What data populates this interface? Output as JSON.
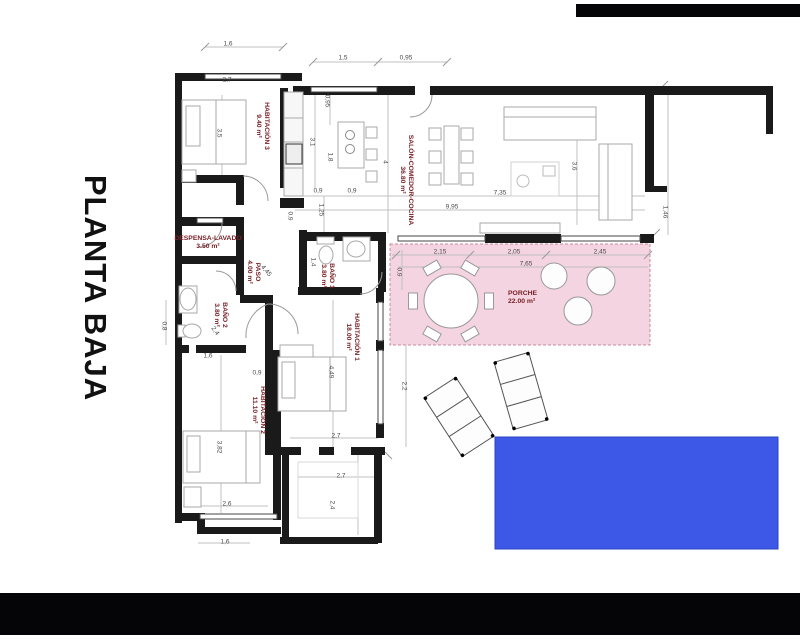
{
  "title": {
    "text": "PLANTA BAJA"
  },
  "plan": {
    "rooms": [
      {
        "name": "HABITACIÓN 3",
        "area": "9.40 m²",
        "x": 262,
        "y": 126,
        "rot": 90
      },
      {
        "name": "SALÓN-COMEDOR-COCINA",
        "area": "36.80 m²",
        "x": 406,
        "y": 180,
        "rot": 90
      },
      {
        "name": "DESPENSA-LAVADO",
        "area": "3.50 m²",
        "x": 208,
        "y": 243,
        "rot": 0
      },
      {
        "name": "PASO",
        "area": "4.00 m²",
        "x": 253,
        "y": 272,
        "rot": 90
      },
      {
        "name": "BAÑO 1",
        "area": "3.80 m²",
        "x": 327,
        "y": 276,
        "rot": 90
      },
      {
        "name": "BAÑO 2",
        "area": "3.80 m²",
        "x": 220,
        "y": 315,
        "rot": 90
      },
      {
        "name": "HABITACIÓN 1",
        "area": "18.00 m²",
        "x": 352,
        "y": 337,
        "rot": 90
      },
      {
        "name": "HABITACIÓN 2",
        "area": "11.10 m²",
        "x": 258,
        "y": 410,
        "rot": 90
      },
      {
        "name": "PORCHE",
        "area": "22.00 m²",
        "x": 508,
        "y": 298,
        "rot": 0,
        "align": "left"
      }
    ],
    "dimensions": [
      {
        "text": "1,6",
        "x": 228,
        "y": 44,
        "rot": 0
      },
      {
        "text": "2,7",
        "x": 227,
        "y": 80,
        "rot": 0
      },
      {
        "text": "3,5",
        "x": 219,
        "y": 133,
        "rot": 90
      },
      {
        "text": "1,5",
        "x": 343,
        "y": 58,
        "rot": 0
      },
      {
        "text": "0,95",
        "x": 406,
        "y": 58,
        "rot": 0
      },
      {
        "text": "0,95",
        "x": 327,
        "y": 101,
        "rot": 90
      },
      {
        "text": "3,1",
        "x": 312,
        "y": 142,
        "rot": 90
      },
      {
        "text": "1,8",
        "x": 330,
        "y": 157,
        "rot": 90
      },
      {
        "text": "4",
        "x": 385,
        "y": 162,
        "rot": 90
      },
      {
        "text": "3,6",
        "x": 574,
        "y": 166,
        "rot": 90
      },
      {
        "text": "7,35",
        "x": 500,
        "y": 193,
        "rot": 0
      },
      {
        "text": "9,95",
        "x": 452,
        "y": 207,
        "rot": 0
      },
      {
        "text": "0,9",
        "x": 318,
        "y": 191,
        "rot": 0
      },
      {
        "text": "0,9",
        "x": 352,
        "y": 191,
        "rot": 0
      },
      {
        "text": "1,25",
        "x": 321,
        "y": 210,
        "rot": 90
      },
      {
        "text": "0,9",
        "x": 290,
        "y": 216,
        "rot": 90
      },
      {
        "text": "1,46",
        "x": 665,
        "y": 212,
        "rot": 90
      },
      {
        "text": "2,15",
        "x": 440,
        "y": 252,
        "rot": 0
      },
      {
        "text": "2,05",
        "x": 514,
        "y": 252,
        "rot": 0
      },
      {
        "text": "2,45",
        "x": 600,
        "y": 252,
        "rot": 0
      },
      {
        "text": "7,65",
        "x": 526,
        "y": 264,
        "rot": 0
      },
      {
        "text": "0,9",
        "x": 399,
        "y": 272,
        "rot": 90
      },
      {
        "text": "4,45",
        "x": 266,
        "y": 271,
        "rot": 50
      },
      {
        "text": "1,4",
        "x": 313,
        "y": 262,
        "rot": 90
      },
      {
        "text": "2,4",
        "x": 215,
        "y": 331,
        "rot": 55
      },
      {
        "text": "0,8",
        "x": 164,
        "y": 326,
        "rot": 90
      },
      {
        "text": "1,6",
        "x": 208,
        "y": 356,
        "rot": 0
      },
      {
        "text": "0,9",
        "x": 257,
        "y": 373,
        "rot": 0
      },
      {
        "text": "4,49",
        "x": 331,
        "y": 372,
        "rot": 90
      },
      {
        "text": "2,2",
        "x": 404,
        "y": 386,
        "rot": 90
      },
      {
        "text": "3,82",
        "x": 219,
        "y": 447,
        "rot": 90
      },
      {
        "text": "2,7",
        "x": 336,
        "y": 436,
        "rot": 0
      },
      {
        "text": "2,7",
        "x": 341,
        "y": 476,
        "rot": 0
      },
      {
        "text": "2,4",
        "x": 332,
        "y": 505,
        "rot": 90
      },
      {
        "text": "2,6",
        "x": 227,
        "y": 504,
        "rot": 0
      },
      {
        "text": "1,6",
        "x": 225,
        "y": 542,
        "rot": 0
      }
    ],
    "colors": {
      "wall": "#1a1a1a",
      "label": "#7a2127",
      "dim": "#4a4a4a",
      "porch_fill": "#f3d4e0",
      "porch_border": "#c9899e",
      "pool_fill": "#3d57e6",
      "pool_border": "#2b44c0",
      "furniture": "#a8a8a8",
      "line": "#c0c0c0",
      "bar": "#050507"
    }
  }
}
